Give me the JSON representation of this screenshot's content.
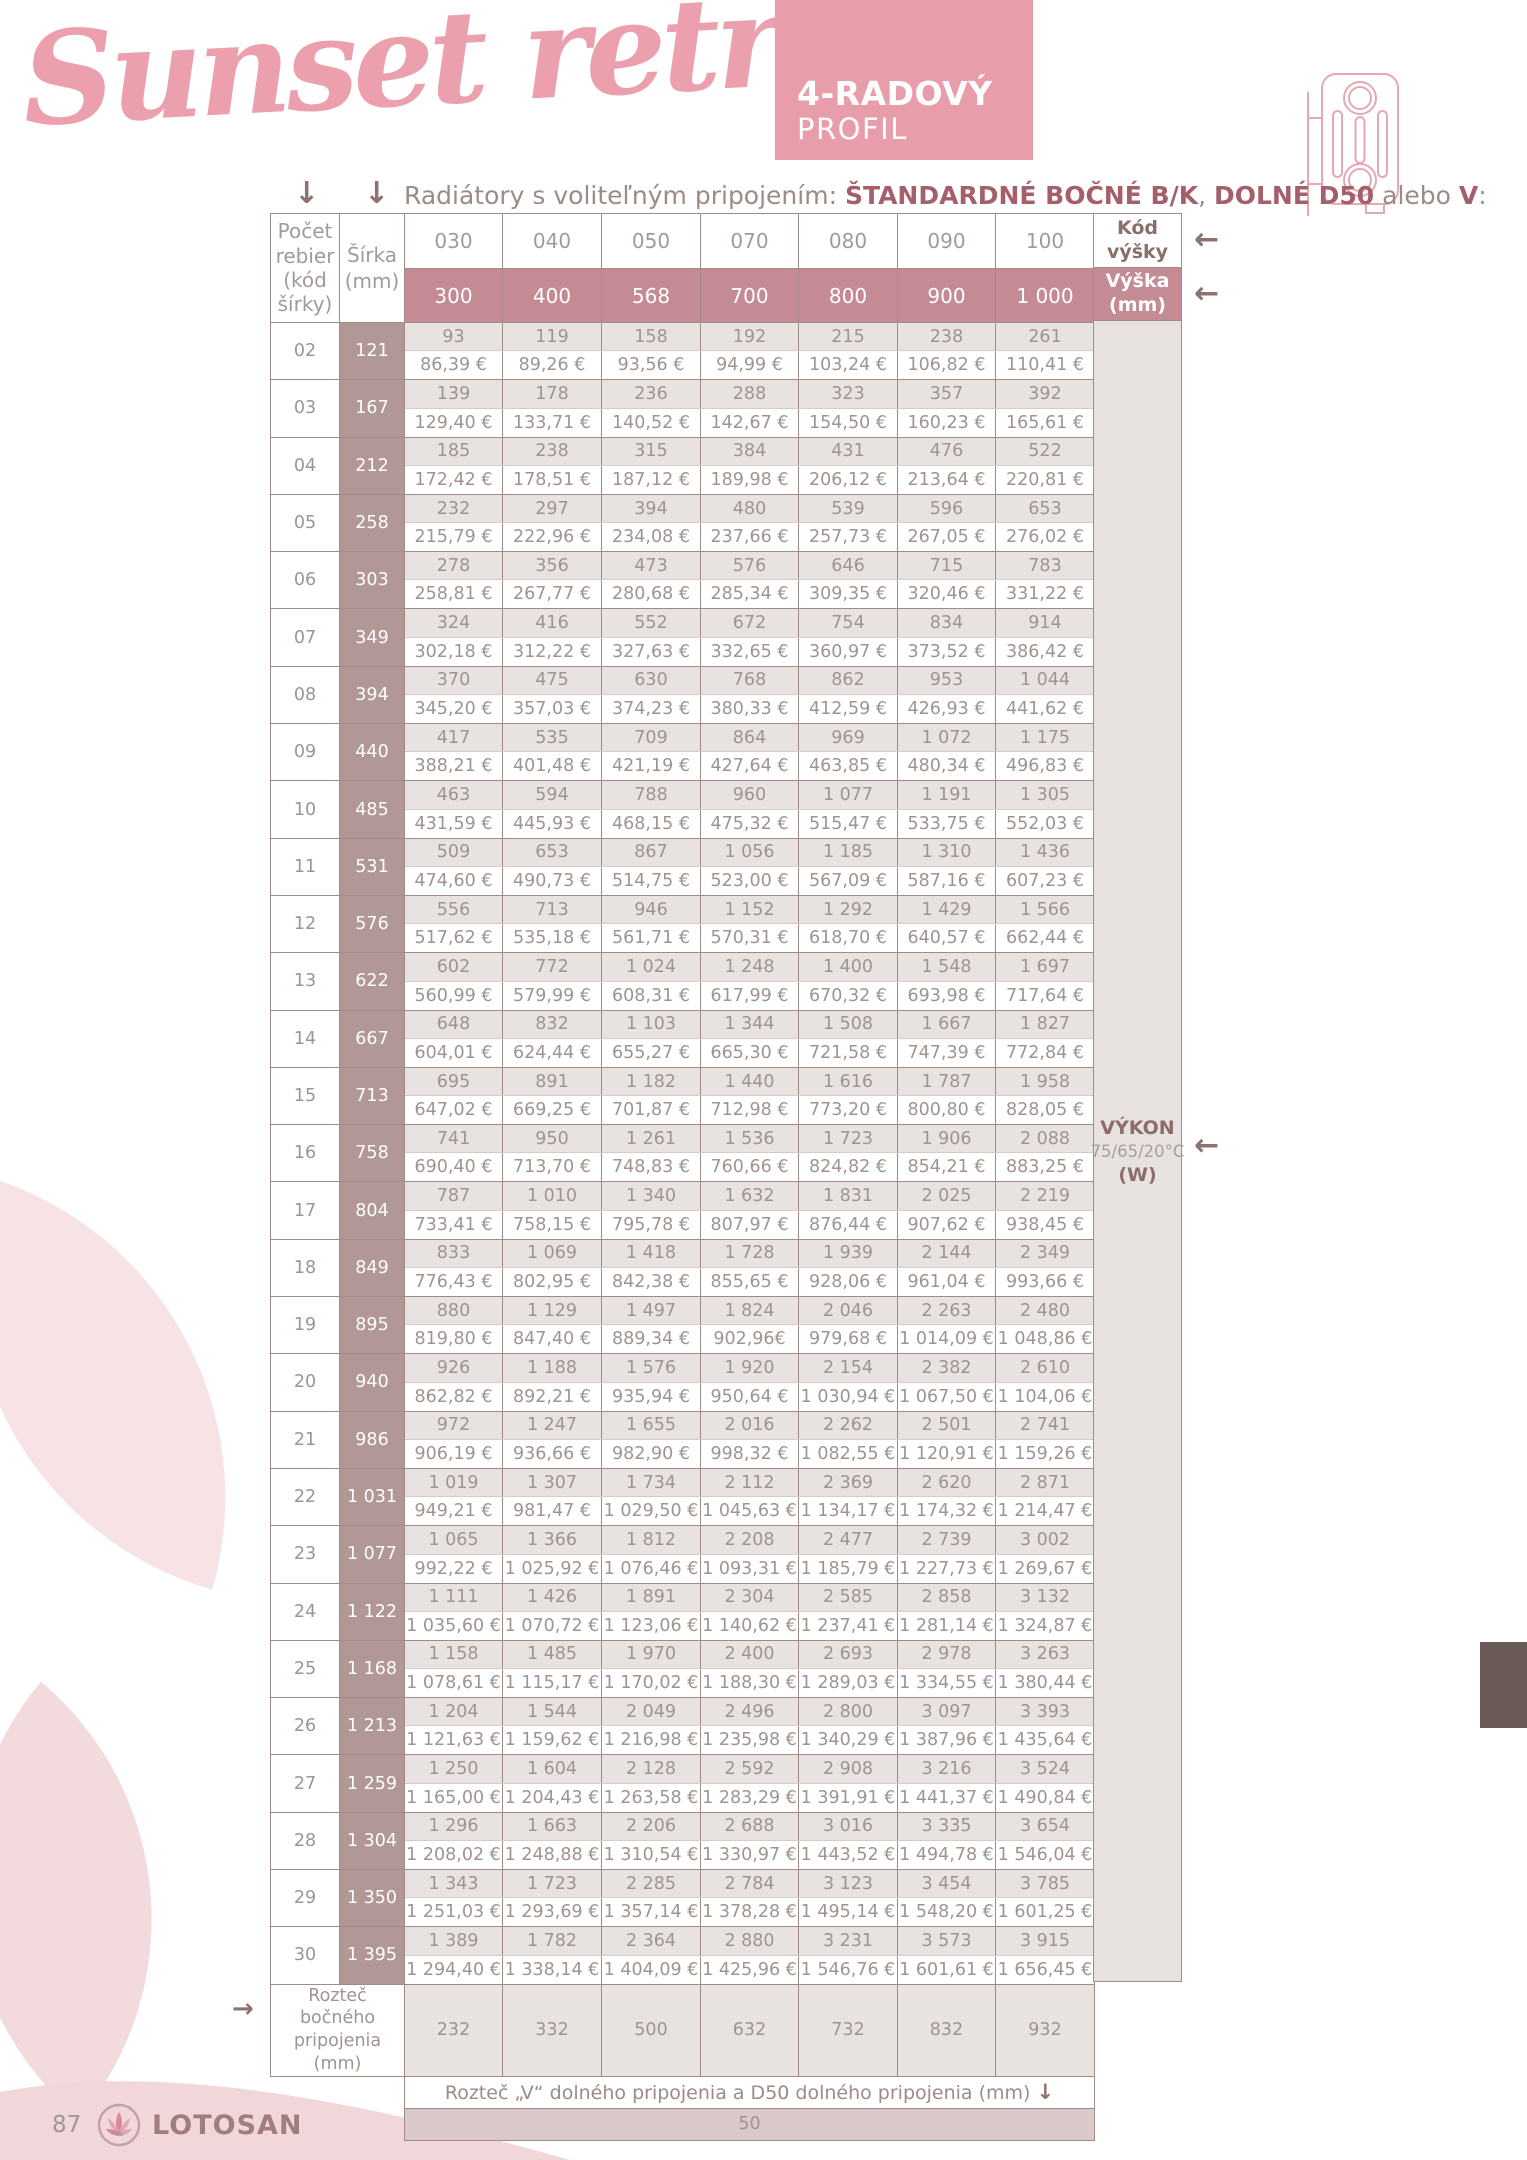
{
  "page": {
    "title_script": "Sunset retro",
    "badge": {
      "line1": "4-RADOVÝ",
      "line2": "PROFIL"
    },
    "subtitle": {
      "prefix": "Radiátory s voliteľným pripojením: ",
      "bold1": "ŠTANDARDNÉ BOČNÉ B/K",
      "sep1": ", ",
      "bold2": "DOLNÉ D50",
      "sep2": " alebo ",
      "bold3": "V",
      "suffix": ":"
    },
    "page_number": "87",
    "brand": "LOTOSAN"
  },
  "table": {
    "corner_header": "Počet rebier (kód šírky)",
    "width_header": "Šírka (mm)",
    "height_code_header": "Kód výšky",
    "height_mm_header": "Výška (mm)",
    "power_label": {
      "line1": "VÝKON",
      "line2": "75/65/20°C",
      "line3": "(W)"
    },
    "height_codes": [
      "030",
      "040",
      "050",
      "070",
      "080",
      "090",
      "100"
    ],
    "heights_mm": [
      "300",
      "400",
      "568",
      "700",
      "800",
      "900",
      "1 000"
    ],
    "rows": [
      {
        "code": "02",
        "width": "121",
        "watts": [
          "93",
          "119",
          "158",
          "192",
          "215",
          "238",
          "261"
        ],
        "prices": [
          "86,39 €",
          "89,26 €",
          "93,56 €",
          "94,99 €",
          "103,24 €",
          "106,82 €",
          "110,41 €"
        ]
      },
      {
        "code": "03",
        "width": "167",
        "watts": [
          "139",
          "178",
          "236",
          "288",
          "323",
          "357",
          "392"
        ],
        "prices": [
          "129,40 €",
          "133,71 €",
          "140,52 €",
          "142,67 €",
          "154,50 €",
          "160,23 €",
          "165,61 €"
        ]
      },
      {
        "code": "04",
        "width": "212",
        "watts": [
          "185",
          "238",
          "315",
          "384",
          "431",
          "476",
          "522"
        ],
        "prices": [
          "172,42 €",
          "178,51 €",
          "187,12 €",
          "189,98 €",
          "206,12 €",
          "213,64 €",
          "220,81 €"
        ]
      },
      {
        "code": "05",
        "width": "258",
        "watts": [
          "232",
          "297",
          "394",
          "480",
          "539",
          "596",
          "653"
        ],
        "prices": [
          "215,79 €",
          "222,96 €",
          "234,08 €",
          "237,66 €",
          "257,73 €",
          "267,05 €",
          "276,02 €"
        ]
      },
      {
        "code": "06",
        "width": "303",
        "watts": [
          "278",
          "356",
          "473",
          "576",
          "646",
          "715",
          "783"
        ],
        "prices": [
          "258,81 €",
          "267,77 €",
          "280,68 €",
          "285,34 €",
          "309,35 €",
          "320,46 €",
          "331,22 €"
        ]
      },
      {
        "code": "07",
        "width": "349",
        "watts": [
          "324",
          "416",
          "552",
          "672",
          "754",
          "834",
          "914"
        ],
        "prices": [
          "302,18 €",
          "312,22 €",
          "327,63 €",
          "332,65 €",
          "360,97 €",
          "373,52 €",
          "386,42 €"
        ]
      },
      {
        "code": "08",
        "width": "394",
        "watts": [
          "370",
          "475",
          "630",
          "768",
          "862",
          "953",
          "1 044"
        ],
        "prices": [
          "345,20 €",
          "357,03 €",
          "374,23 €",
          "380,33 €",
          "412,59 €",
          "426,93 €",
          "441,62 €"
        ]
      },
      {
        "code": "09",
        "width": "440",
        "watts": [
          "417",
          "535",
          "709",
          "864",
          "969",
          "1 072",
          "1 175"
        ],
        "prices": [
          "388,21 €",
          "401,48 €",
          "421,19 €",
          "427,64 €",
          "463,85 €",
          "480,34 €",
          "496,83 €"
        ]
      },
      {
        "code": "10",
        "width": "485",
        "watts": [
          "463",
          "594",
          "788",
          "960",
          "1 077",
          "1 191",
          "1 305"
        ],
        "prices": [
          "431,59 €",
          "445,93 €",
          "468,15 €",
          "475,32 €",
          "515,47 €",
          "533,75 €",
          "552,03 €"
        ]
      },
      {
        "code": "11",
        "width": "531",
        "watts": [
          "509",
          "653",
          "867",
          "1 056",
          "1 185",
          "1 310",
          "1 436"
        ],
        "prices": [
          "474,60 €",
          "490,73 €",
          "514,75 €",
          "523,00 €",
          "567,09 €",
          "587,16 €",
          "607,23 €"
        ]
      },
      {
        "code": "12",
        "width": "576",
        "watts": [
          "556",
          "713",
          "946",
          "1 152",
          "1 292",
          "1 429",
          "1 566"
        ],
        "prices": [
          "517,62 €",
          "535,18 €",
          "561,71 €",
          "570,31 €",
          "618,70 €",
          "640,57 €",
          "662,44 €"
        ]
      },
      {
        "code": "13",
        "width": "622",
        "watts": [
          "602",
          "772",
          "1 024",
          "1 248",
          "1 400",
          "1 548",
          "1 697"
        ],
        "prices": [
          "560,99 €",
          "579,99 €",
          "608,31 €",
          "617,99 €",
          "670,32 €",
          "693,98 €",
          "717,64 €"
        ]
      },
      {
        "code": "14",
        "width": "667",
        "watts": [
          "648",
          "832",
          "1 103",
          "1 344",
          "1 508",
          "1 667",
          "1 827"
        ],
        "prices": [
          "604,01 €",
          "624,44 €",
          "655,27 €",
          "665,30 €",
          "721,58 €",
          "747,39 €",
          "772,84 €"
        ]
      },
      {
        "code": "15",
        "width": "713",
        "watts": [
          "695",
          "891",
          "1 182",
          "1 440",
          "1 616",
          "1 787",
          "1 958"
        ],
        "prices": [
          "647,02 €",
          "669,25 €",
          "701,87 €",
          "712,98 €",
          "773,20 €",
          "800,80 €",
          "828,05 €"
        ]
      },
      {
        "code": "16",
        "width": "758",
        "watts": [
          "741",
          "950",
          "1 261",
          "1 536",
          "1 723",
          "1 906",
          "2 088"
        ],
        "prices": [
          "690,40 €",
          "713,70 €",
          "748,83 €",
          "760,66 €",
          "824,82 €",
          "854,21 €",
          "883,25 €"
        ]
      },
      {
        "code": "17",
        "width": "804",
        "watts": [
          "787",
          "1 010",
          "1 340",
          "1 632",
          "1 831",
          "2 025",
          "2 219"
        ],
        "prices": [
          "733,41 €",
          "758,15 €",
          "795,78 €",
          "807,97 €",
          "876,44 €",
          "907,62 €",
          "938,45 €"
        ]
      },
      {
        "code": "18",
        "width": "849",
        "watts": [
          "833",
          "1 069",
          "1 418",
          "1 728",
          "1 939",
          "2 144",
          "2 349"
        ],
        "prices": [
          "776,43 €",
          "802,95 €",
          "842,38 €",
          "855,65 €",
          "928,06 €",
          "961,04 €",
          "993,66 €"
        ]
      },
      {
        "code": "19",
        "width": "895",
        "watts": [
          "880",
          "1 129",
          "1 497",
          "1 824",
          "2 046",
          "2 263",
          "2 480"
        ],
        "prices": [
          "819,80 €",
          "847,40 €",
          "889,34 €",
          "902,96€",
          "979,68 €",
          "1 014,09 €",
          "1 048,86 €"
        ]
      },
      {
        "code": "20",
        "width": "940",
        "watts": [
          "926",
          "1 188",
          "1 576",
          "1 920",
          "2 154",
          "2 382",
          "2 610"
        ],
        "prices": [
          "862,82 €",
          "892,21 €",
          "935,94 €",
          "950,64 €",
          "1 030,94 €",
          "1 067,50 €",
          "1 104,06 €"
        ]
      },
      {
        "code": "21",
        "width": "986",
        "watts": [
          "972",
          "1 247",
          "1 655",
          "2 016",
          "2 262",
          "2 501",
          "2 741"
        ],
        "prices": [
          "906,19 €",
          "936,66 €",
          "982,90 €",
          "998,32 €",
          "1 082,55 €",
          "1 120,91 €",
          "1 159,26 €"
        ]
      },
      {
        "code": "22",
        "width": "1 031",
        "watts": [
          "1 019",
          "1 307",
          "1 734",
          "2 112",
          "2 369",
          "2 620",
          "2 871"
        ],
        "prices": [
          "949,21 €",
          "981,47 €",
          "1 029,50 €",
          "1 045,63 €",
          "1 134,17 €",
          "1 174,32 €",
          "1 214,47 €"
        ]
      },
      {
        "code": "23",
        "width": "1 077",
        "watts": [
          "1 065",
          "1 366",
          "1 812",
          "2 208",
          "2 477",
          "2 739",
          "3 002"
        ],
        "prices": [
          "992,22 €",
          "1 025,92 €",
          "1 076,46 €",
          "1 093,31 €",
          "1 185,79 €",
          "1 227,73 €",
          "1 269,67 €"
        ]
      },
      {
        "code": "24",
        "width": "1 122",
        "watts": [
          "1 111",
          "1 426",
          "1 891",
          "2 304",
          "2 585",
          "2 858",
          "3 132"
        ],
        "prices": [
          "1 035,60 €",
          "1 070,72 €",
          "1 123,06 €",
          "1 140,62 €",
          "1 237,41 €",
          "1 281,14 €",
          "1 324,87 €"
        ]
      },
      {
        "code": "25",
        "width": "1 168",
        "watts": [
          "1 158",
          "1 485",
          "1 970",
          "2 400",
          "2 693",
          "2 978",
          "3 263"
        ],
        "prices": [
          "1 078,61 €",
          "1 115,17 €",
          "1 170,02 €",
          "1 188,30 €",
          "1 289,03 €",
          "1 334,55 €",
          "1 380,44 €"
        ]
      },
      {
        "code": "26",
        "width": "1 213",
        "watts": [
          "1 204",
          "1 544",
          "2 049",
          "2 496",
          "2 800",
          "3 097",
          "3 393"
        ],
        "prices": [
          "1 121,63 €",
          "1 159,62 €",
          "1 216,98 €",
          "1 235,98 €",
          "1 340,29 €",
          "1 387,96 €",
          "1 435,64 €"
        ]
      },
      {
        "code": "27",
        "width": "1 259",
        "watts": [
          "1 250",
          "1 604",
          "2 128",
          "2 592",
          "2 908",
          "3 216",
          "3 524"
        ],
        "prices": [
          "1 165,00 €",
          "1 204,43 €",
          "1 263,58 €",
          "1 283,29 €",
          "1 391,91 €",
          "1 441,37 €",
          "1 490,84 €"
        ]
      },
      {
        "code": "28",
        "width": "1 304",
        "watts": [
          "1 296",
          "1 663",
          "2 206",
          "2 688",
          "3 016",
          "3 335",
          "3 654"
        ],
        "prices": [
          "1 208,02 €",
          "1 248,88 €",
          "1 310,54 €",
          "1 330,97 €",
          "1 443,52 €",
          "1 494,78 €",
          "1 546,04 €"
        ]
      },
      {
        "code": "29",
        "width": "1 350",
        "watts": [
          "1 343",
          "1 723",
          "2 285",
          "2 784",
          "3 123",
          "3 454",
          "3 785"
        ],
        "prices": [
          "1 251,03 €",
          "1 293,69 €",
          "1 357,14 €",
          "1 378,28 €",
          "1 495,14 €",
          "1 548,20 €",
          "1 601,25 €"
        ]
      },
      {
        "code": "30",
        "width": "1 395",
        "watts": [
          "1 389",
          "1 782",
          "2 364",
          "2 880",
          "3 231",
          "3 573",
          "3 915"
        ],
        "prices": [
          "1 294,40 €",
          "1 338,14 €",
          "1 404,09 €",
          "1 425,96 €",
          "1 546,76 €",
          "1 601,61 €",
          "1 656,45 €"
        ]
      }
    ],
    "footer": {
      "side_pitch_label": "Rozteč bočného pripojenia (mm)",
      "side_pitch_values": [
        "232",
        "332",
        "500",
        "632",
        "732",
        "832",
        "932"
      ],
      "bottom_pitch_label": "Rozteč „V“ dolného pripojenia a D50 dolného pripojenia (mm)",
      "bottom_pitch_value": "50"
    }
  },
  "icons": {
    "down_arrow": "↓",
    "left_arrow": "←",
    "right_arrow": "→"
  },
  "colors": {
    "accent_pink": "#e89dab",
    "title_pink": "#ec9fad",
    "header_mauve": "#c48b94",
    "width_col_mauve": "#b19896",
    "watt_cell_bg": "#e8e2e0",
    "fifty_row_bg": "#dac9c8",
    "dark_tab": "#695a57",
    "cell_text_gray": "#9e9490",
    "label_mauve_brown": "#8b6d69"
  }
}
